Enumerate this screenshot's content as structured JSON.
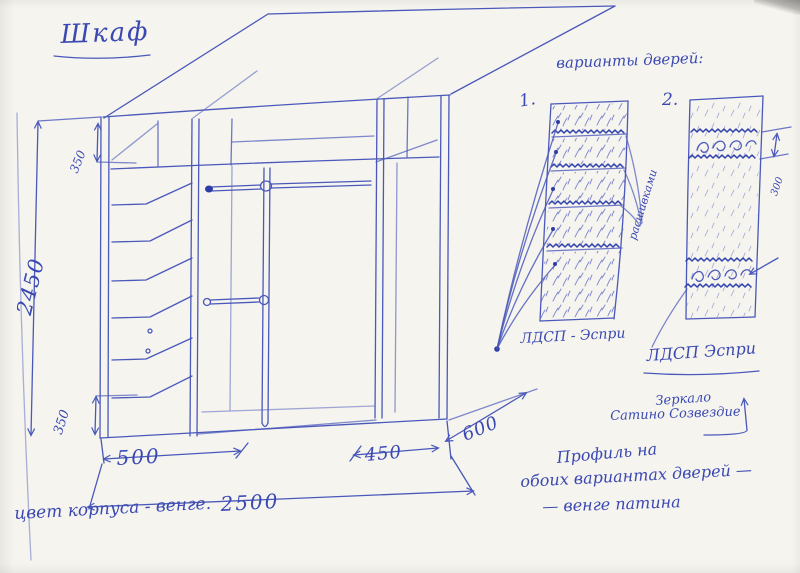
{
  "page": {
    "title": "Шкаф"
  },
  "main_drawing": {
    "dims": {
      "height": "2450",
      "top_section": "350",
      "bottom_section": "350",
      "left_width": "500",
      "right_width": "450",
      "depth": "600",
      "total_width": "2500"
    },
    "body_color_note": "цвет корпуса - венге."
  },
  "door_variants": {
    "heading": "варианты дверей:",
    "variant1": {
      "number": "1.",
      "material": "ЛДСП - Эспри",
      "grooves": "расшивками"
    },
    "variant2": {
      "number": "2.",
      "material": "ЛДСП Эспри",
      "band_height": "300",
      "mirror_line1": "Зеркало",
      "mirror_line2": "Сатино Созвездие"
    },
    "profile_note": {
      "line1": "Профиль на",
      "line2": "обоих вариантах дверей —",
      "line3": "— венге патина"
    }
  },
  "colors": {
    "ink": "#4a58ba",
    "ink_dark": "#3243ac",
    "paper": "#f5f4ef"
  }
}
